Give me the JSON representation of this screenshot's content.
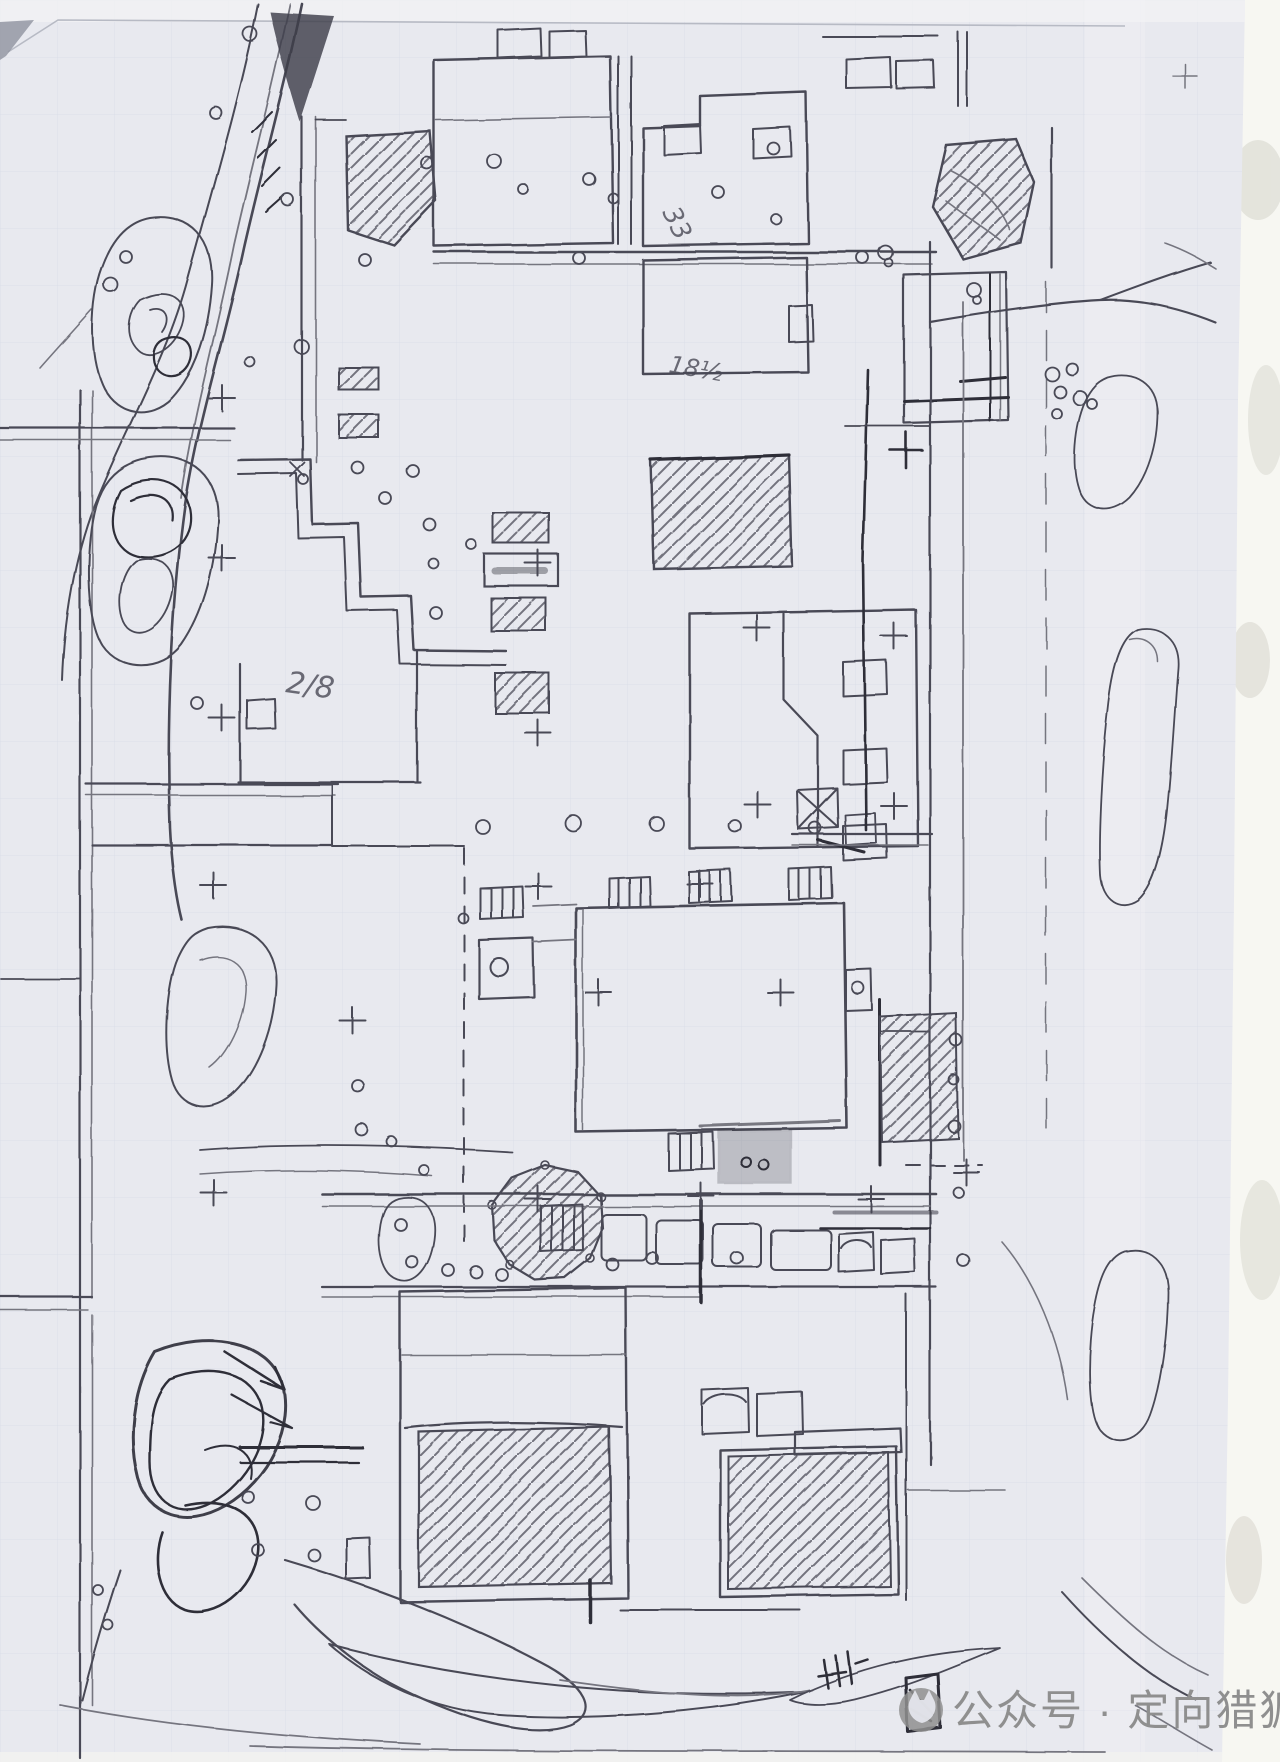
{
  "palette": {
    "paper": "#e8e9ef",
    "pencil": "#4a4a56",
    "pencil_dark": "#2d2d38",
    "pencil_light": "#75757f",
    "scan_bg": "#f7f7f2",
    "grid": "#ccd1df",
    "watermark_gray": "#8f8f8f",
    "edge": "#b7bac4"
  },
  "annotations": {
    "note_33": "33",
    "note_18": "18½",
    "note_28": "2/8"
  },
  "watermark": {
    "logo": "fox-logo",
    "text": "公众号 · 定向猎狐"
  }
}
